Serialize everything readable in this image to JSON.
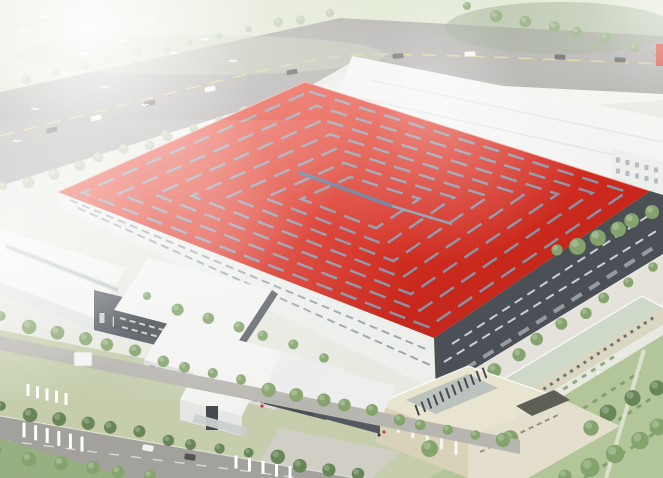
{
  "scene": {
    "type": "aerial-architectural-rendering",
    "landmarks": [
      "main-factory-red-roof",
      "skylight-strips",
      "rear-white-factory",
      "left-white-warehouse",
      "center-white-building",
      "front-office-complex",
      "beige-office-building",
      "green-roof-utility-building",
      "upper-boulevard",
      "front-street",
      "campus-road",
      "crosswalks",
      "tree-rows",
      "flying-birds",
      "cars",
      "guard-booth",
      "lawn-with-hedges"
    ]
  },
  "colors": {
    "roof_red": "#da2418",
    "roof_red_light": "#e63522",
    "roof_red_dark": "#c01c0f",
    "strip": "#7e93ab",
    "ridge": "#50698e",
    "facade_dark": "#42474d",
    "facade_window": "#c9ced3",
    "wall_white": "#ecefec",
    "wall_shadow": "#e0e3e0",
    "roof_white": "#f3f4f2",
    "bay_gray": "#a7b0b8",
    "road_gray": "#a3a19d",
    "street_gray": "#9e9c96",
    "lane_yellow": "#d8c77f",
    "pavement": "#e3e1d8",
    "plaza": "#cfcdc2",
    "campus_road": "#b5b3ac",
    "tree_green": "#7fa066",
    "tree_green_dark": "#5f8150",
    "tree_green_pale": "#b7c4a4",
    "lawn": "#aec394",
    "grass": "#c2cba8",
    "lawn_dark": "#93ab7c",
    "hedge": "#7d9c66",
    "field_pale": "#dce4cc",
    "beige_wall": "#d6d0b5",
    "beige_roof": "#e8e3cd",
    "beige_wing": "#e3decb",
    "brown_block": "#56584c",
    "green_roof": "#cdd7c8",
    "louver": "#39414a",
    "louver_bed": "#b9c0ba",
    "car_dark": "#4a4a4a",
    "car_white": "#f2f2f0",
    "bird_white": "#ffffff",
    "booth_white": "#f4f4f0",
    "people_red": "#c03028",
    "people_dark": "#3a3a3a",
    "haze": "#ffffff"
  }
}
